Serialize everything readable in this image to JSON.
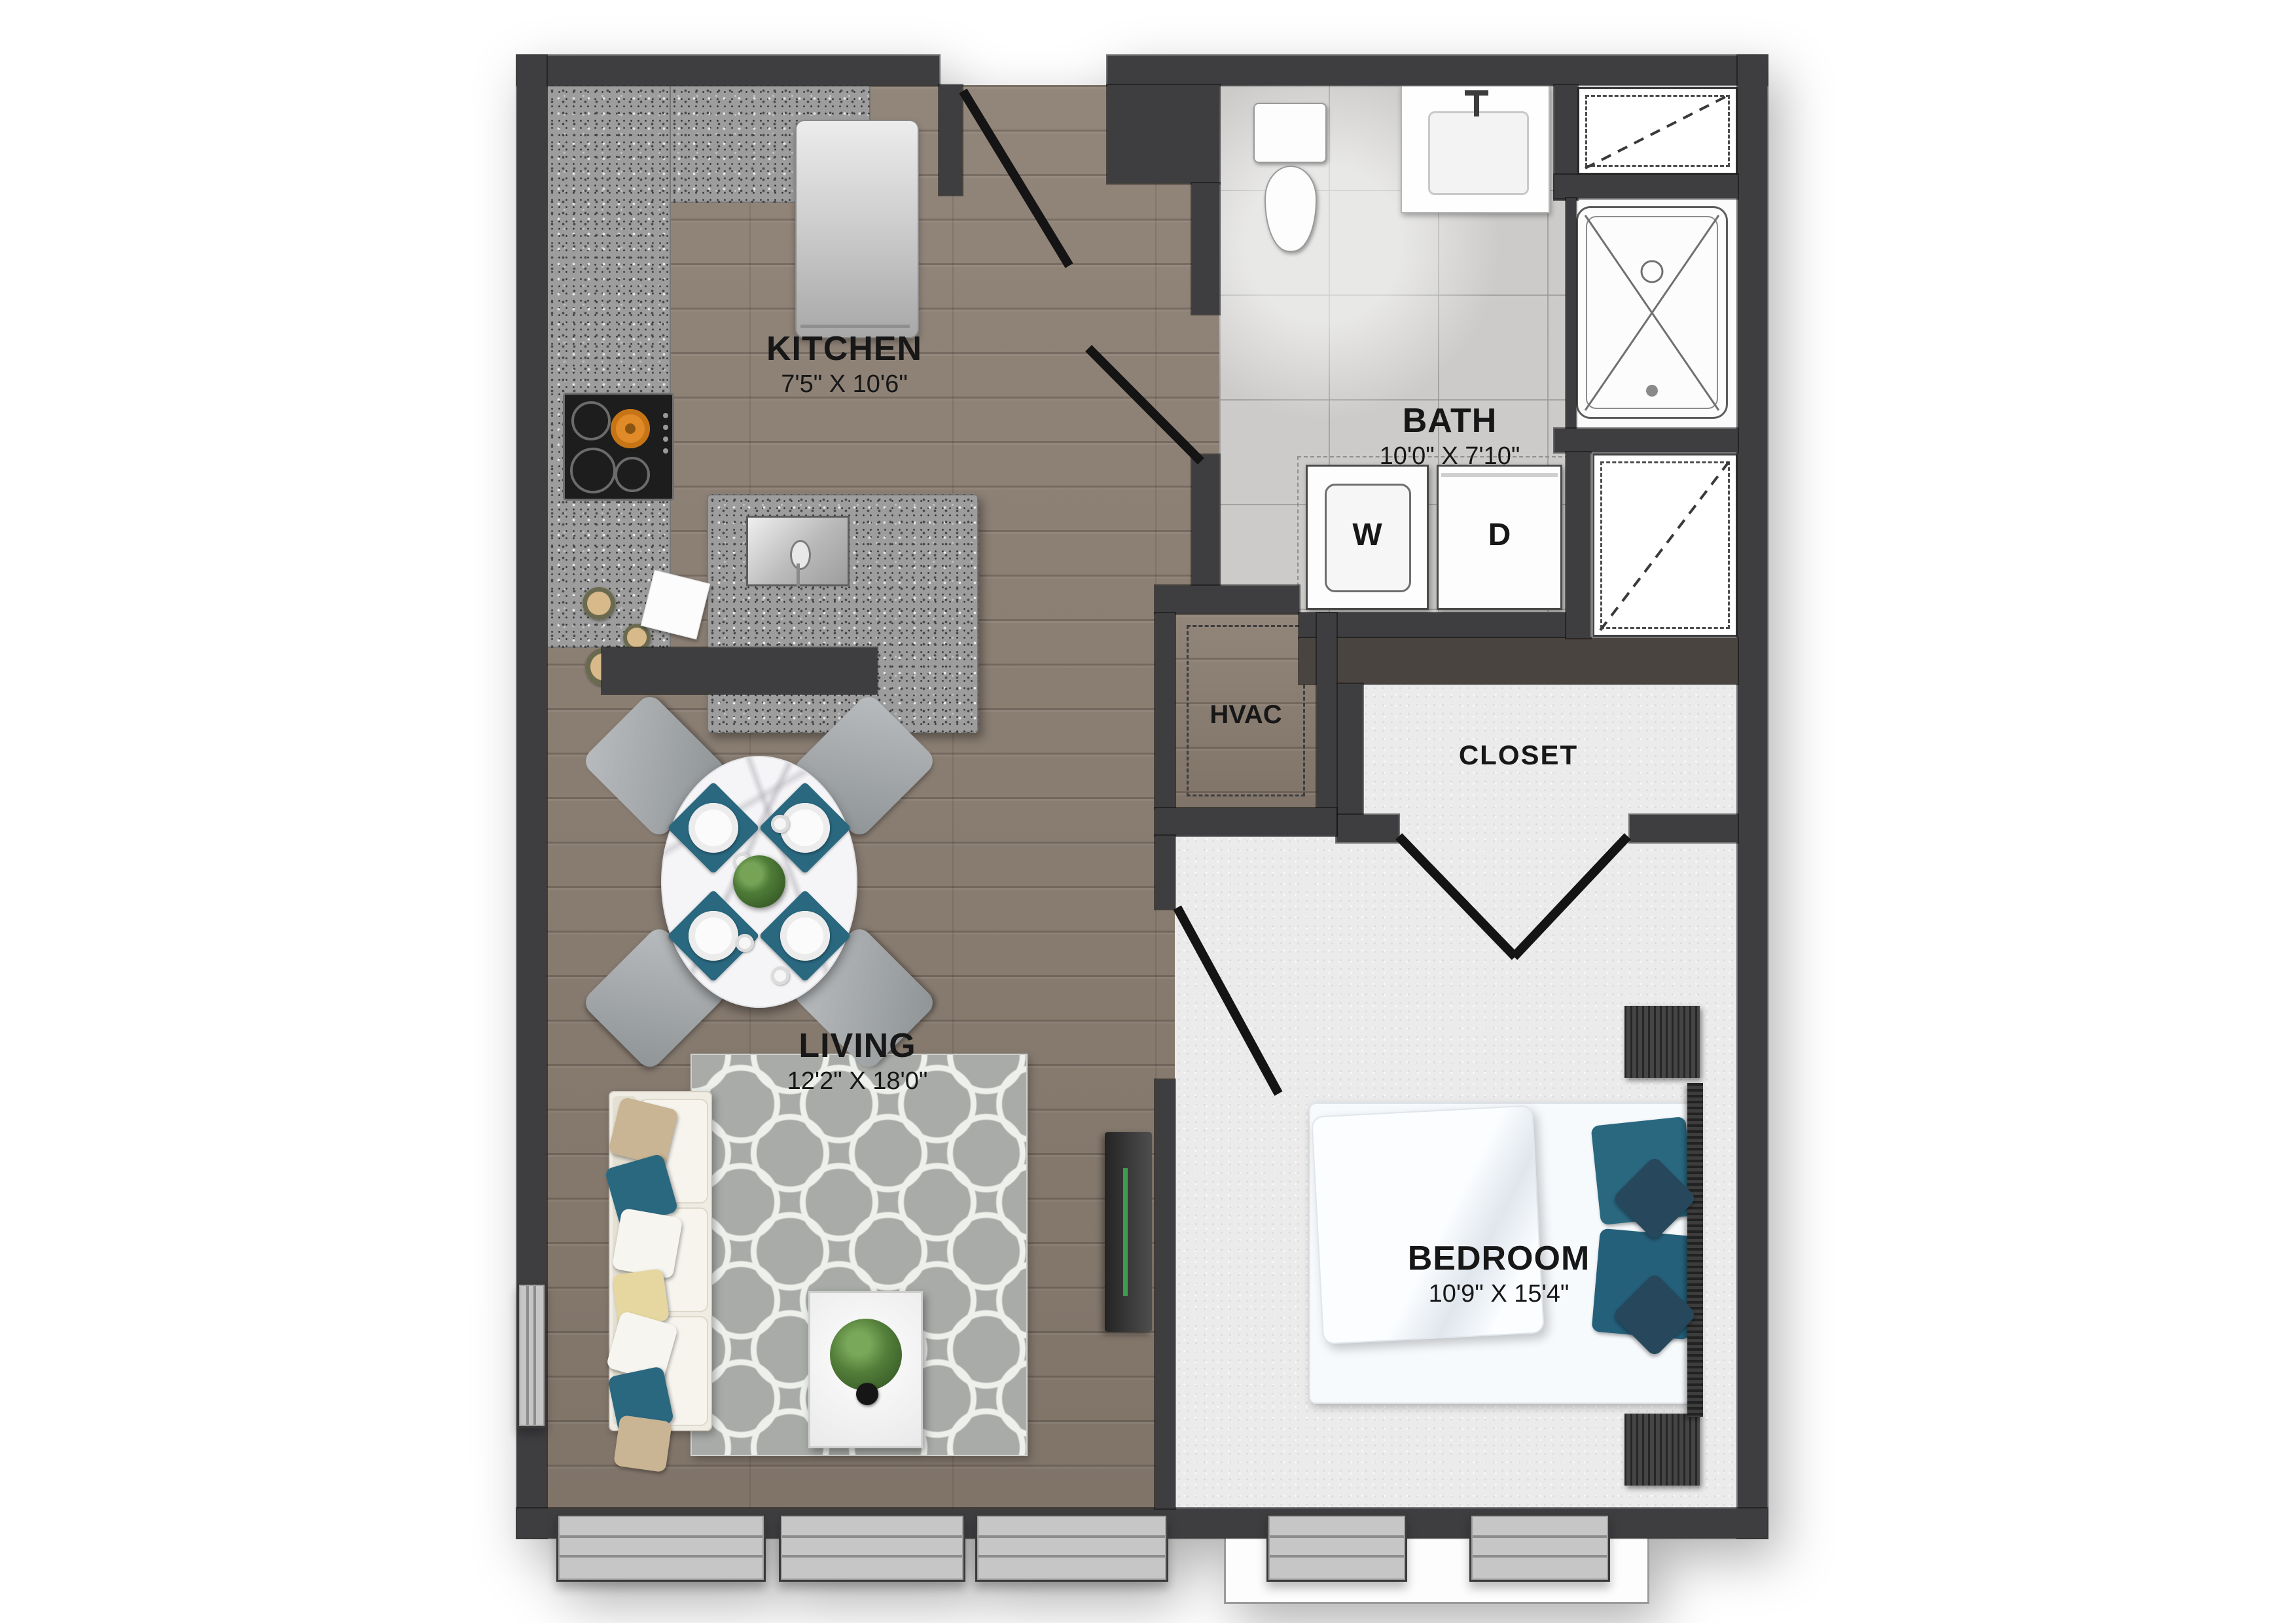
{
  "plan": {
    "title": "one-bedroom-apartment-floor-plan",
    "rooms": [
      {
        "id": "kitchen",
        "label": "KITCHEN",
        "dims": "7'5\" X 10'6\""
      },
      {
        "id": "bath",
        "label": "BATH",
        "dims": "10'0\" X 7'10\""
      },
      {
        "id": "living",
        "label": "LIVING",
        "dims": "12'2\" X 18'0\""
      },
      {
        "id": "bedroom",
        "label": "BEDROOM",
        "dims": "10'9\" X 15'4\""
      },
      {
        "id": "hvac",
        "label": "HVAC"
      },
      {
        "id": "closet",
        "label": "CLOSET"
      }
    ],
    "appliances": {
      "washer": "W",
      "dryer": "D"
    },
    "colors": {
      "wall": "#3e3e41",
      "wood": "#8b7e72",
      "tile": "#cccbc9",
      "carpet": "#ebebeb",
      "granite": "#9d9d9d",
      "rug": "#a8aba7",
      "accent_teal": "#2a6880",
      "door_line": "#141414"
    }
  }
}
